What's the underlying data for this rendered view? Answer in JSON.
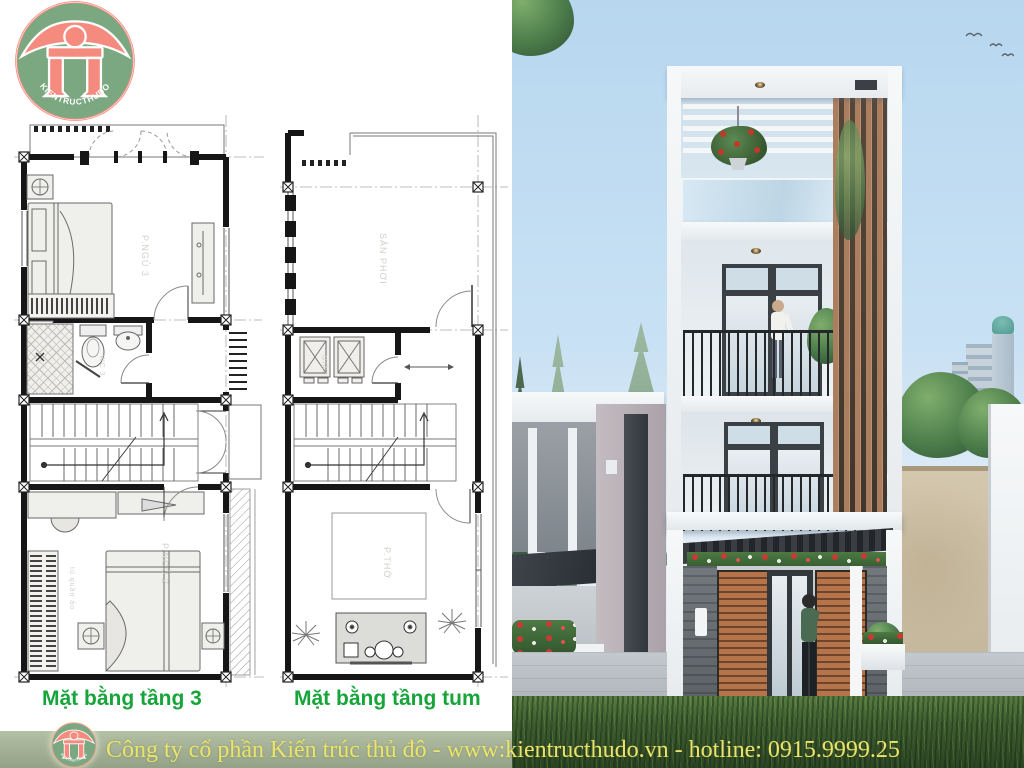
{
  "logo": {
    "brand": "KIENTRUCTHUDO"
  },
  "plans": {
    "floor3": {
      "caption": "Mặt bằng tầng 3",
      "rooms": {
        "bedroom3": "P.NGỦ 3",
        "wc": "WC 3",
        "bedroom2": "P.NGỦ 2",
        "wardrobe": "tủ quần áo"
      }
    },
    "tum": {
      "caption": "Mặt bằng tầng tum",
      "rooms": {
        "terrace": "SÂN PHƠI",
        "laundry": "GIẶT",
        "worship": "P.THỜ"
      }
    }
  },
  "footer": {
    "text": "Công ty cổ phần Kiến trúc thủ đô - www:kientructhudo.vn - hotline: 0915.9999.25"
  },
  "colors": {
    "caption_green": "#17a53b",
    "footer_text": "#eae46c",
    "footer_bg": "#a5b297",
    "logo_green": "#7ca881",
    "logo_ring_pink": "#f3897e",
    "logo_glyph_pink": "#f58a7e",
    "wood_slat": "#a97e5f",
    "sky_top": "#b7d7ef",
    "plan_wall": "#161616"
  }
}
